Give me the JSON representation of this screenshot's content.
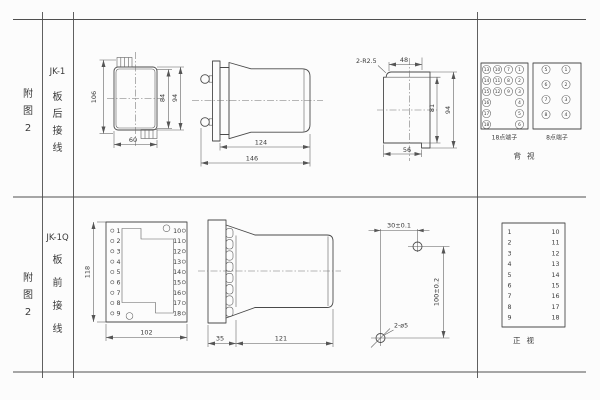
{
  "sidebar": {
    "row1": {
      "fig": [
        "附",
        "图",
        "2"
      ],
      "model": "JK-1",
      "wiring": [
        "板",
        "后",
        "接",
        "线"
      ]
    },
    "row2": {
      "fig": [
        "附",
        "图",
        "2"
      ],
      "model": "JK-1Q",
      "wiring": [
        "板",
        "前",
        "接",
        "线"
      ]
    }
  },
  "jk1_front": {
    "dim_height_total": "106",
    "dim_height_inner": "84",
    "dim_height_outer": "94",
    "dim_width": "60"
  },
  "jk1_side": {
    "dim_body": "124",
    "dim_total": "146"
  },
  "jk1_rear": {
    "corner_note": "2-R2.5",
    "dim_top": "48",
    "dim_right_inner": "81",
    "dim_right_outer": "94",
    "dim_bottom": "56"
  },
  "rear_terminals": {
    "block18": {
      "label": "18点端子",
      "grid": [
        [
          "13",
          "10",
          "7",
          "1"
        ],
        [
          "14",
          "11",
          "8",
          "2"
        ],
        [
          "15",
          "12",
          "9",
          "3"
        ]
      ],
      "left": [
        "16",
        "17",
        "18"
      ],
      "right": [
        "4",
        "5",
        "6"
      ]
    },
    "block8": {
      "label": "8点端子",
      "left": [
        "5",
        "6",
        "7",
        "8"
      ],
      "right": [
        "1",
        "2",
        "3",
        "4"
      ]
    },
    "view_label": "背视"
  },
  "jk1q_front": {
    "dim_height": "118",
    "dim_width": "102",
    "left": [
      "1",
      "2",
      "3",
      "4",
      "5",
      "6",
      "7",
      "8",
      "9"
    ],
    "right": [
      "10",
      "11",
      "12",
      "13",
      "14",
      "15",
      "16",
      "17",
      "18"
    ]
  },
  "jk1q_side": {
    "dim_plate": "35",
    "dim_body": "121"
  },
  "drill": {
    "dim_horizontal": "30±0.1",
    "dim_vertical": "100±0.2",
    "hole_note": "2-ø5"
  },
  "front_list": {
    "left": [
      "1",
      "2",
      "3",
      "4",
      "5",
      "6",
      "7",
      "8",
      "9"
    ],
    "right": [
      "10",
      "11",
      "12",
      "13",
      "14",
      "15",
      "16",
      "17",
      "18"
    ],
    "view_label": "正视"
  }
}
